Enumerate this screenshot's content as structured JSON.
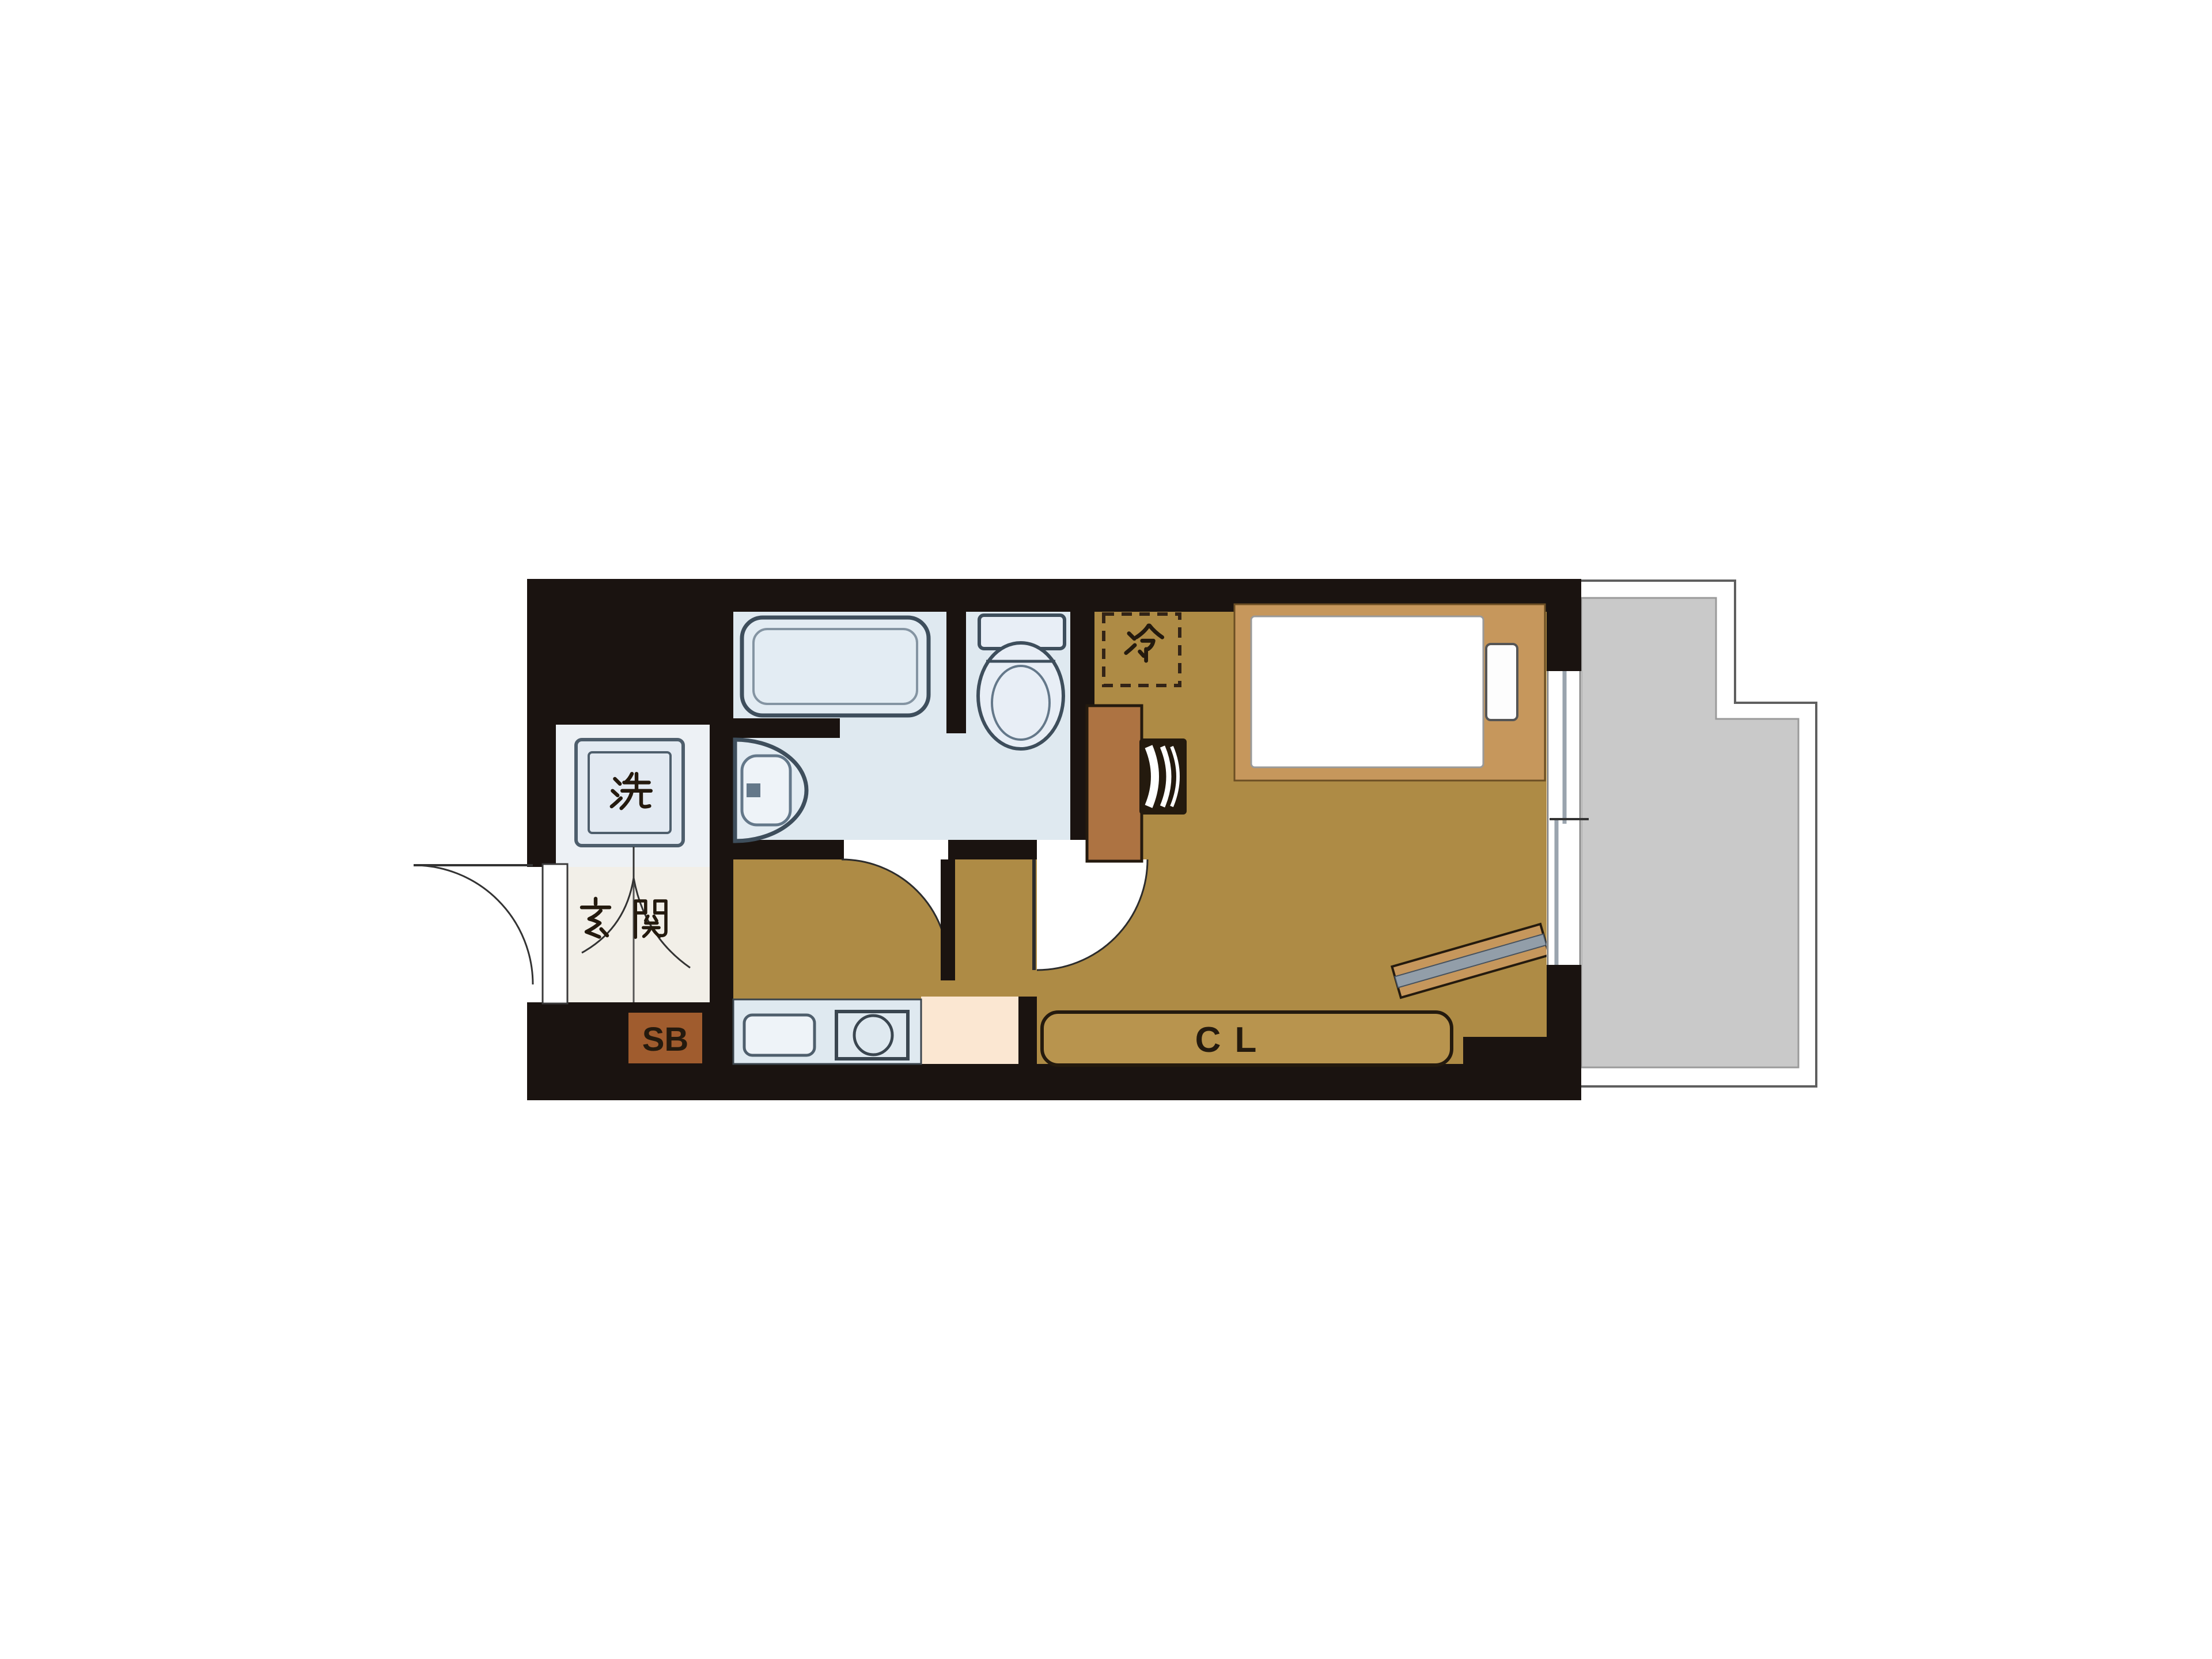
{
  "figure_type": "japanese-apartment-floor-plan",
  "labels": {
    "washer": "洗",
    "entrance": "玄関",
    "shoe_box": "SB",
    "refrigerator": "冷",
    "closet": "CL"
  },
  "colors": {
    "wall": "#1a1310",
    "room_floor": "#ae8b45",
    "wood_accent": "#c6975c",
    "cabinet_brown": "#ad7342",
    "shoe_box_brown": "#a05c2e",
    "bathroom_floor": "#dfe9f0",
    "fixture_fill": "#e3ecf3",
    "fixture_stroke": "#3e4e5c",
    "entrance_floor": "#f2efe8",
    "kitchen_floor_peach": "#fbe7d2",
    "balcony_gray": "#c9c9c9",
    "closet_fill": "#b8944e",
    "ink": "#241a0e"
  }
}
